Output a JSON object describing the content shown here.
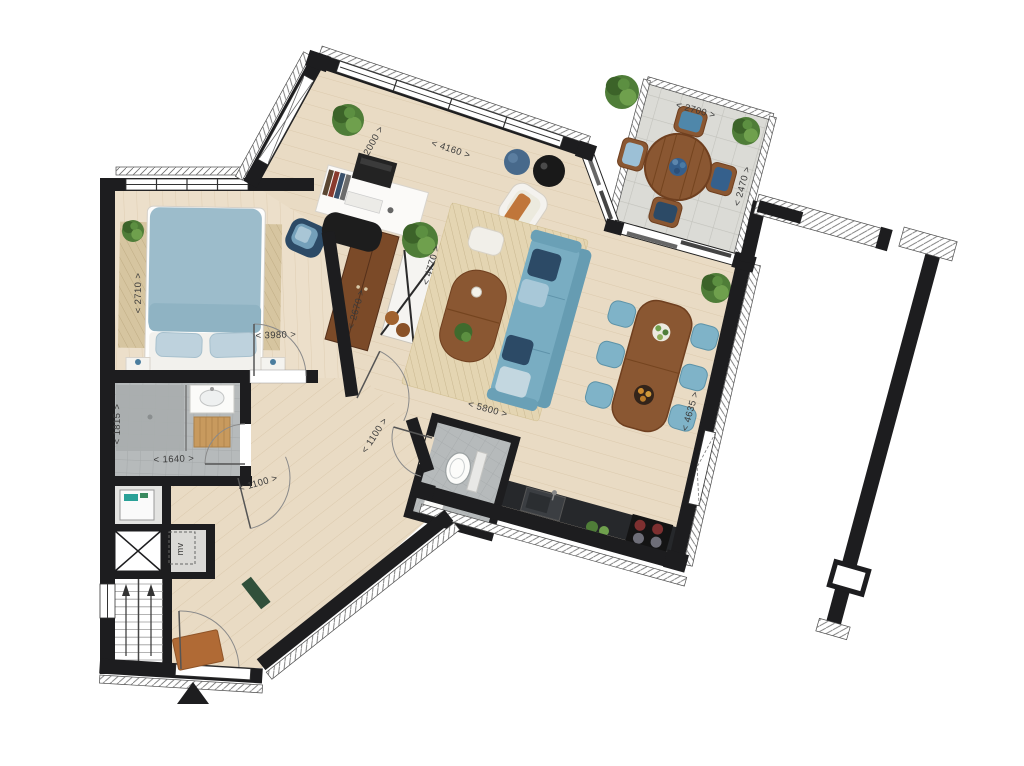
{
  "plan": {
    "type": "apartment-floor-plan",
    "dimension_format": "< {value} >",
    "dimensions": {
      "terrace_width": "2700",
      "terrace_depth": "2470",
      "living_top_window": "4160",
      "upper_left_window": "2000",
      "bedroom_width": "2710",
      "bedroom_length": "3980",
      "wardrobe_wall": "2670",
      "living_left_depth": "4770",
      "bathroom_width": "1815",
      "bathroom_length": "1640",
      "hall_door": "1100",
      "corridor_door": "1100",
      "living_width": "5800",
      "living_right_depth": "4635"
    },
    "labels": {
      "mech_vent": "mv"
    },
    "icons": [
      "entrance-arrow",
      "elevator-cross",
      "stair-direction-arrow",
      "door-swing-arc"
    ],
    "colors": {
      "wall": "#1d1d1f",
      "wood": "#e9dbc4",
      "woodBed": "#ecdfca",
      "tile": "#b6babb",
      "shower": "#a9adae",
      "terrace": "#dbdbd6",
      "rug": "#e4d5b2",
      "rugBed": "#d6c5a0",
      "sofa": "#79adc2",
      "chair": "#7fb3c8",
      "navy": "#2c4a66",
      "duvet": "#9cbccb",
      "furnWood": "#8a5732",
      "furnWoodDark": "#6f3f1f",
      "wardrobe": "#7b4a28",
      "white": "#f4f2ee",
      "orange": "#c0763a",
      "counter": "#26282b",
      "plant": "#4f7d38",
      "dimText": "#3b3b3b"
    }
  }
}
